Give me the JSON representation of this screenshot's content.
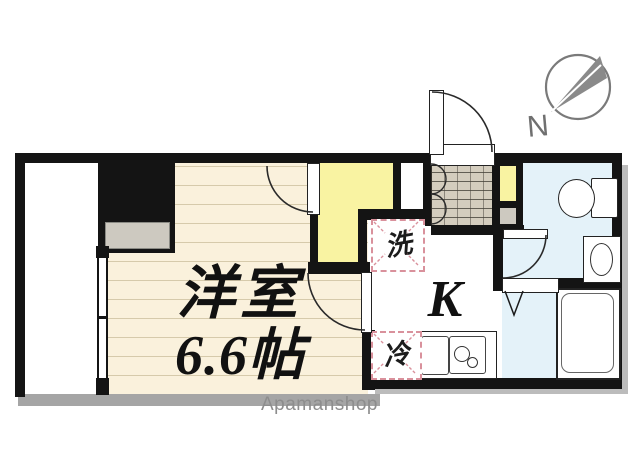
{
  "floorplan": {
    "main_room": {
      "name": "洋室",
      "area": "6.6帖"
    },
    "kitchen_label": "K",
    "washing_machine_label": "洗",
    "refrigerator_label": "冷",
    "compass_label": "N",
    "watermark": "Apamanshop",
    "colors": {
      "room_floor": "#faf1dc",
      "closet": "#f9f3a2",
      "kitchen": "#f7d6da",
      "bath": "#e4f2f9",
      "entrance_tile": "#d4cdbe",
      "wall": "#141414",
      "balcony_edge": "#a5a5a5",
      "dashed_appliance_box": "#d9919c",
      "watermark_gray": "#8d8d8d"
    }
  }
}
